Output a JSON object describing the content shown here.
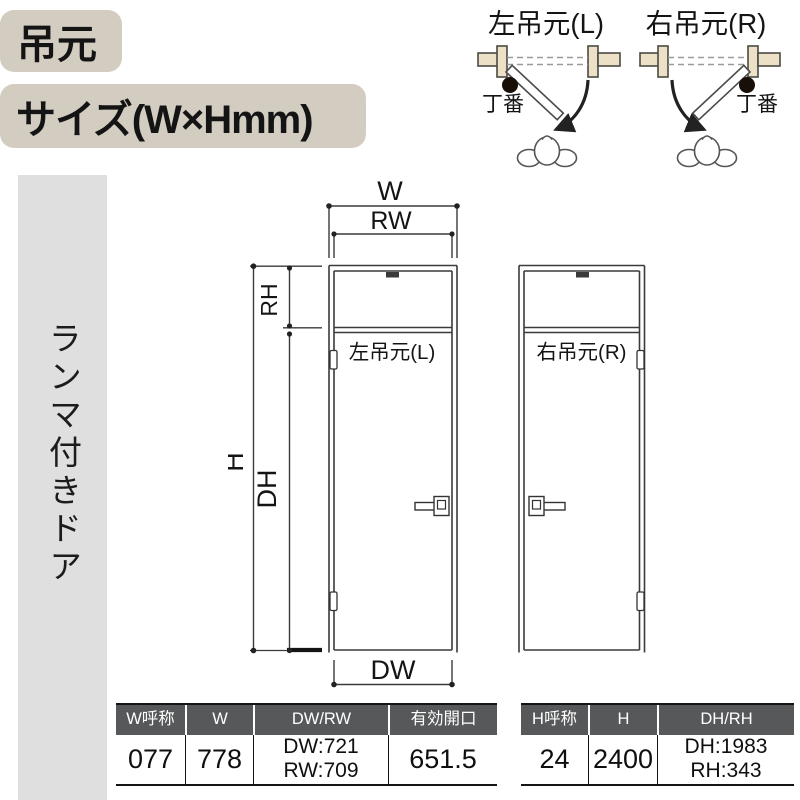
{
  "header": {
    "hinge_side_badge": "吊元",
    "size_badge": "サイズ(W×Hmm)"
  },
  "sidebar": {
    "label": "ランマ付きドア"
  },
  "swing_diagrams": {
    "left": {
      "title": "左吊元(L)",
      "hinge_label": "丁番"
    },
    "right": {
      "title": "右吊元(R)",
      "hinge_label": "丁番"
    }
  },
  "elevation": {
    "dim_labels": {
      "w": "W",
      "rw": "RW",
      "rh": "RH",
      "h": "H",
      "dh": "DH",
      "dw": "DW"
    },
    "left_door_label": "左吊元(L)",
    "right_door_label": "右吊元(R)"
  },
  "tables": {
    "width": {
      "headers": [
        "W呼称",
        "W",
        "DW/RW",
        "有効開口"
      ],
      "row": {
        "w_code": "077",
        "w": "778",
        "dw": "DW:721",
        "rw": "RW:709",
        "opening": "651.5"
      }
    },
    "height": {
      "headers": [
        "H呼称",
        "H",
        "DH/RH"
      ],
      "row": {
        "h_code": "24",
        "h": "2400",
        "dh": "DH:1983",
        "rh": "RH:343"
      }
    }
  },
  "colors": {
    "badge_bg": "#d3cdc1",
    "sidebar_bg": "#dfdfdf",
    "wall_fill": "#ece0c6",
    "table_header_bg": "#57585a",
    "line": "#3a3a3a",
    "text": "#141414"
  }
}
